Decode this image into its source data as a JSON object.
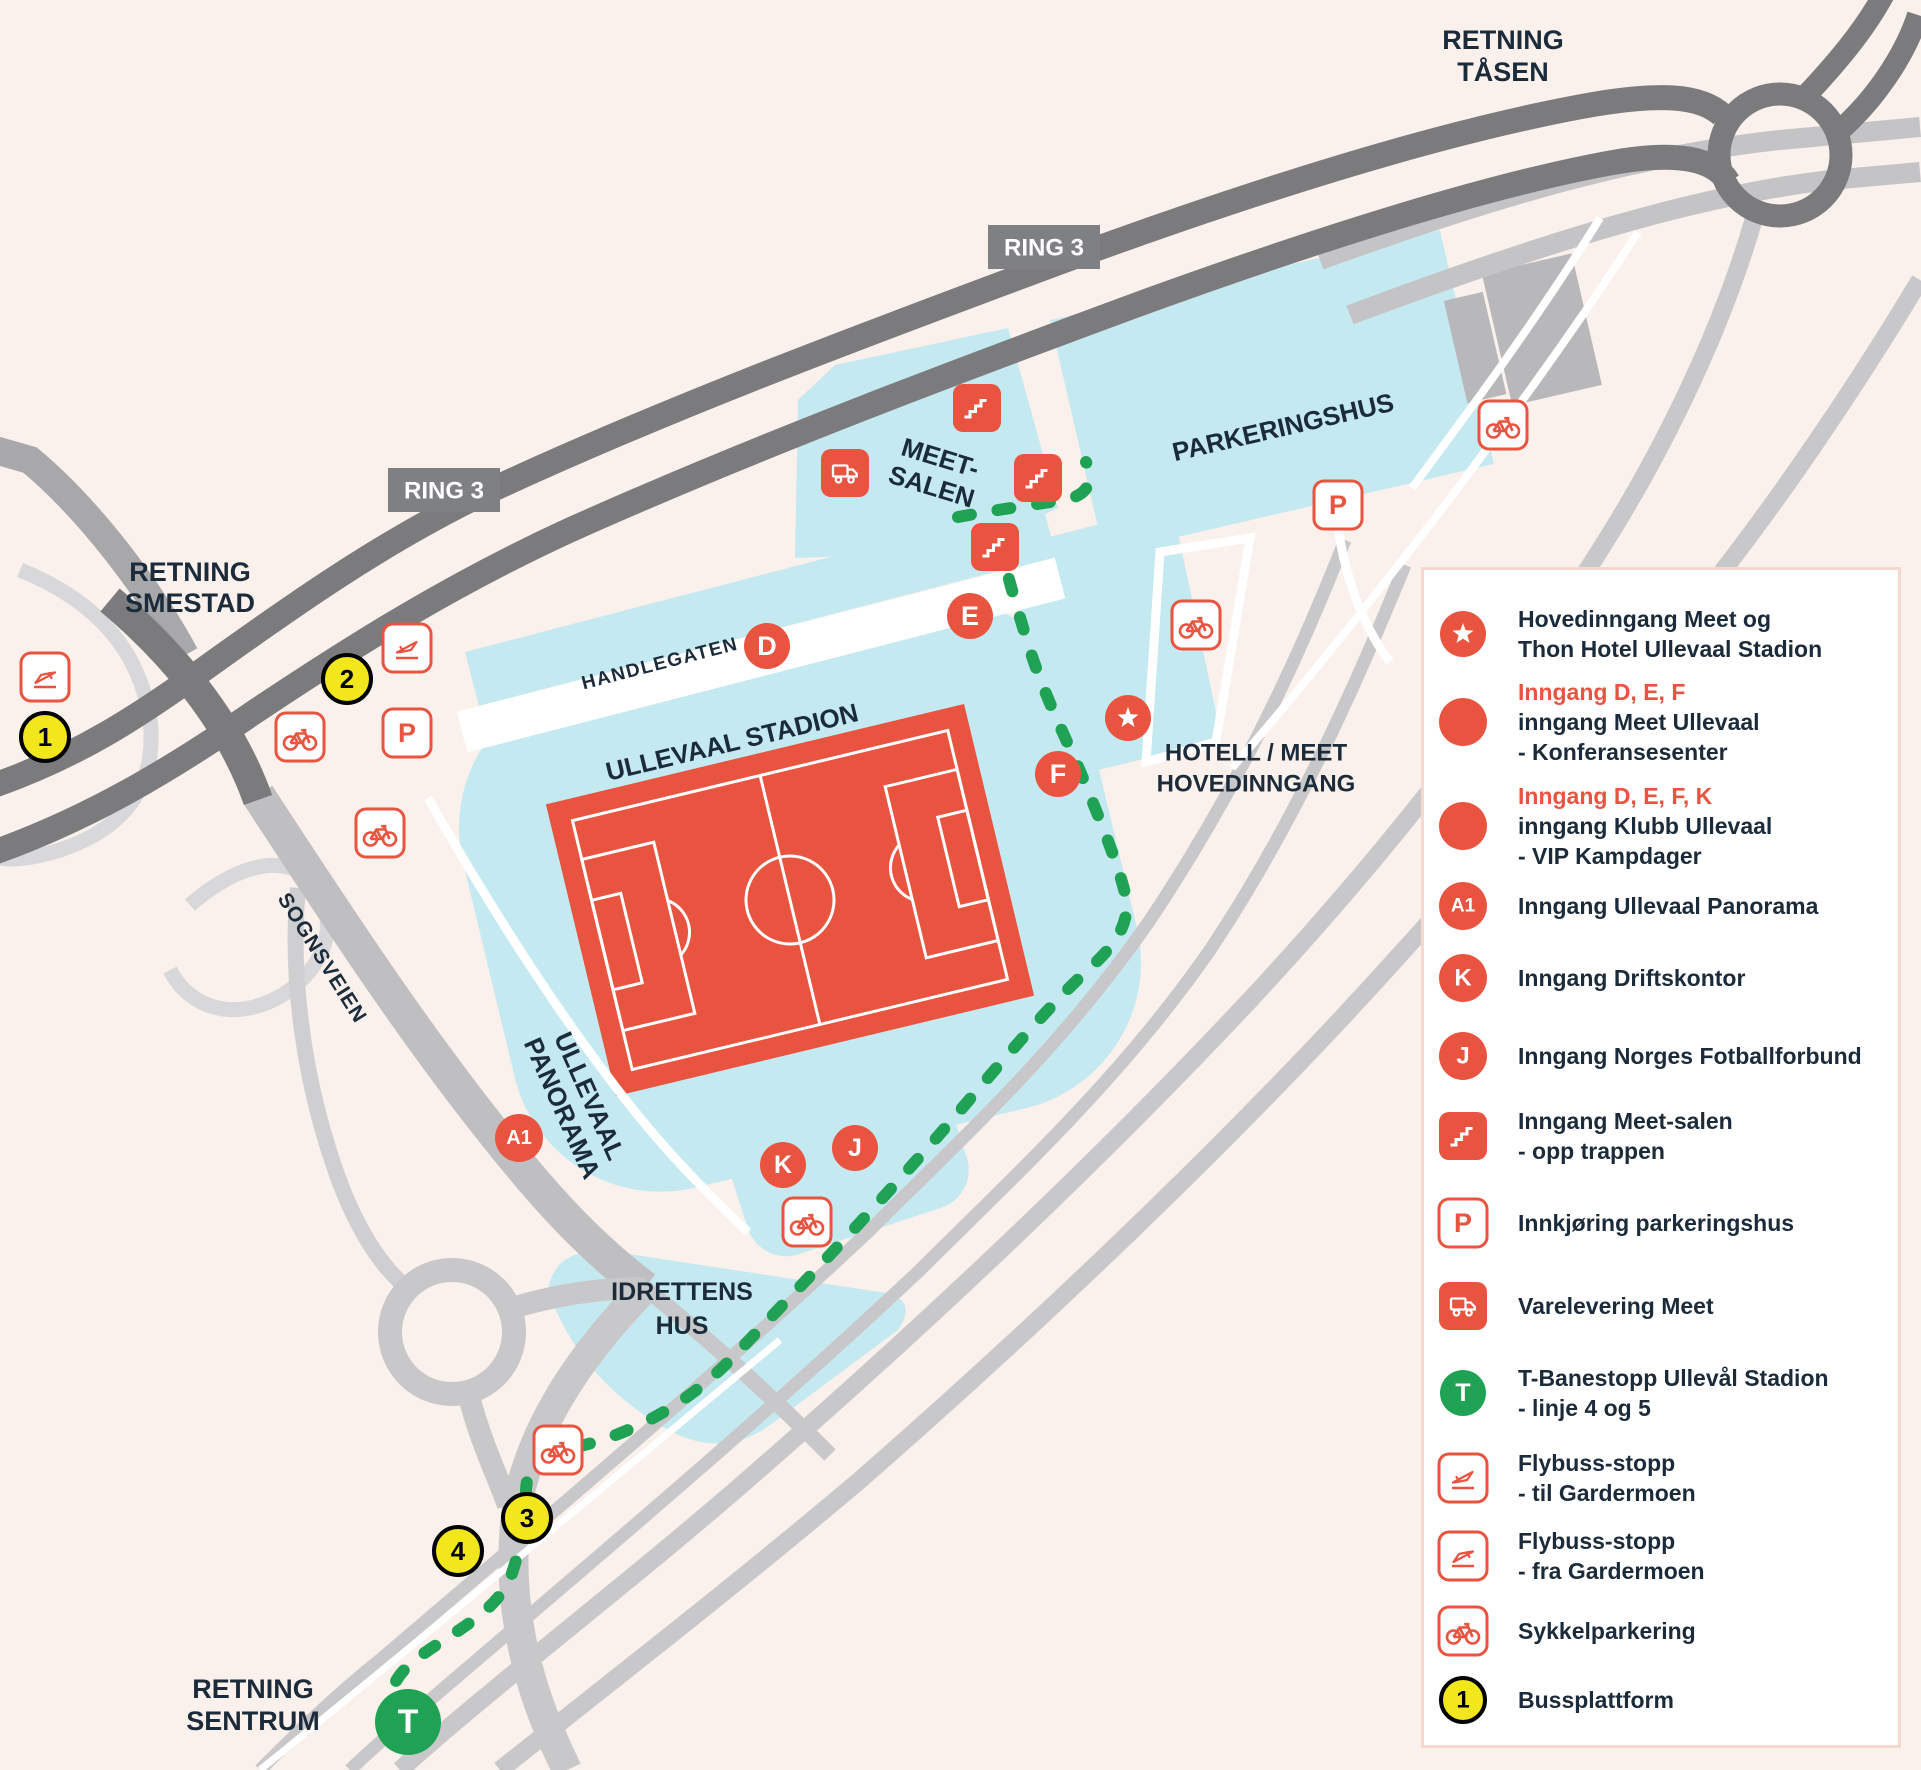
{
  "colors": {
    "background": "#faf0ec",
    "area_blue": "#c5e9f0",
    "accent_red": "#e85440",
    "navy_text": "#1c2b3a",
    "road_dark": "#7b7b7d",
    "road_light": "#c8c8ca",
    "road_ramp": "#d8d8da",
    "route_green": "#1fa254",
    "platform_yellow": "#f2e61c",
    "building_gray": "#b8b8bb",
    "legend_border": "#f5d8d0"
  },
  "map": {
    "direction_labels": {
      "tasen": [
        "RETNING",
        "TÅSEN"
      ],
      "smestad": [
        "RETNING",
        "SMESTAD"
      ],
      "sentrum": [
        "RETNING",
        "SENTRUM"
      ]
    },
    "road_labels": {
      "ring3": "RING 3",
      "sognsveien": "SOGNSVEIEN",
      "handlegaten": "HANDLEGATEN"
    },
    "place_labels": {
      "ullevaal_stadion": "ULLEVAAL STADION",
      "meet_salen": [
        "MEET-",
        "SALEN"
      ],
      "parkeringshus": "PARKERINGSHUS",
      "hotell": [
        "HOTELL / MEET",
        "HOVEDINNGANG"
      ],
      "panorama": [
        "ULLEVAAL",
        "PANORAMA"
      ],
      "idrettens": [
        "IDRETTENS",
        "HUS"
      ]
    },
    "markers": {
      "d": "D",
      "e": "E",
      "f": "F",
      "a1": "A1",
      "k": "K",
      "j": "J",
      "t": "T",
      "p": "P",
      "bus1": "1",
      "bus2": "2",
      "bus3": "3",
      "bus4": "4"
    }
  },
  "legend": {
    "items": [
      {
        "icon": "star-circle",
        "lines": [
          "Hovedinngang Meet og",
          "Thon Hotel Ullevaal Stadion"
        ]
      },
      {
        "icon": "red-circle",
        "title": "Inngang D, E, F",
        "lines": [
          "inngang Meet Ullevaal",
          "- Konferansesenter"
        ]
      },
      {
        "icon": "red-circle",
        "title": "Inngang D, E, F, K",
        "lines": [
          "inngang Klubb Ullevaal",
          "- VIP Kampdager"
        ]
      },
      {
        "icon": "a1-circle",
        "label": "A1",
        "lines": [
          "Inngang Ullevaal Panorama"
        ]
      },
      {
        "icon": "k-circle",
        "label": "K",
        "lines": [
          "Inngang Driftskontor"
        ]
      },
      {
        "icon": "j-circle",
        "label": "J",
        "lines": [
          "Inngang Norges Fotballforbund"
        ]
      },
      {
        "icon": "stairs-square",
        "lines": [
          "Inngang Meet-salen",
          "- opp trappen"
        ]
      },
      {
        "icon": "p-square",
        "label": "P",
        "lines": [
          "Innkjøring parkeringshus"
        ]
      },
      {
        "icon": "truck-square",
        "lines": [
          "Varelevering Meet"
        ]
      },
      {
        "icon": "t-circle",
        "label": "T",
        "lines": [
          "T-Banestopp Ullevål Stadion",
          "- linje 4 og 5"
        ]
      },
      {
        "icon": "plane-takeoff-square",
        "lines": [
          "Flybuss-stopp",
          "- til Gardermoen"
        ]
      },
      {
        "icon": "plane-landing-square",
        "lines": [
          "Flybuss-stopp",
          "- fra Gardermoen"
        ]
      },
      {
        "icon": "bike-square",
        "lines": [
          "Sykkelparkering"
        ]
      },
      {
        "icon": "bus-circle",
        "label": "1",
        "lines": [
          "Bussplattform"
        ]
      }
    ]
  }
}
